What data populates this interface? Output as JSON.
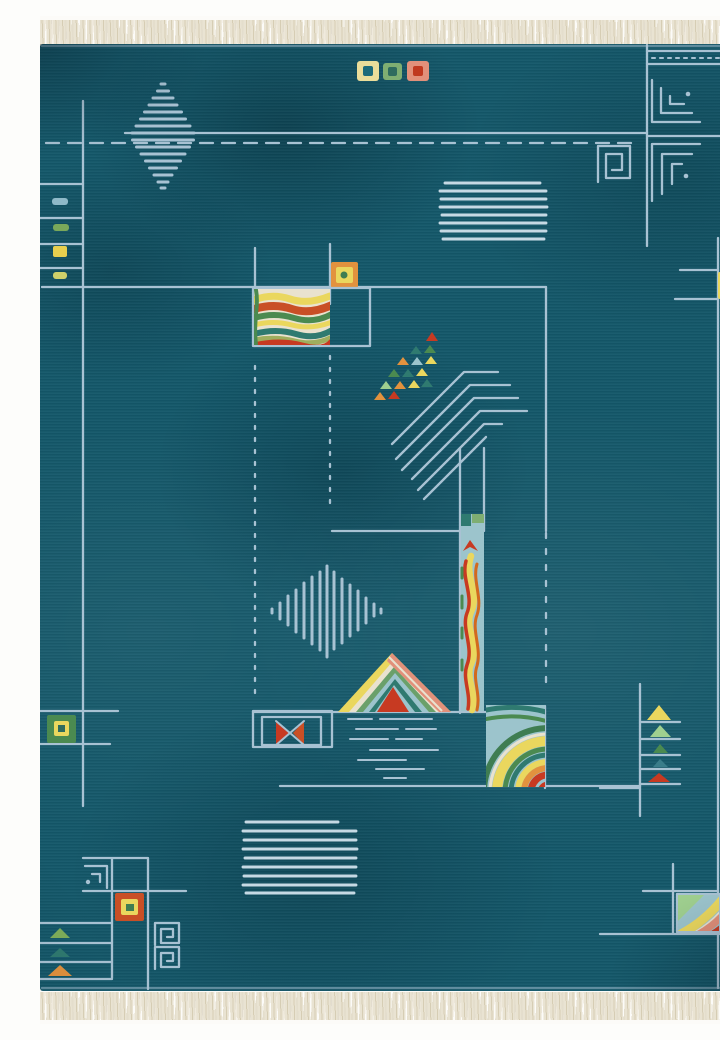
{
  "meta": {
    "description": "Photograph of a teal Art-Deco style Nepalese wool rug with ivory fringe, pale-lavender geometric line work (greek-key corner spirals, hatched diamonds, stripe blocks, dotted grid lines) and multicolor motifs: wavy rainbow panel, confetti triangle tree, serpentine totem column, striped pyramid over water lines, triangle ladder and framed accent squares.",
    "object_type": "area rug photo",
    "text_visible": "none"
  },
  "palette": {
    "base": "#14586a",
    "base-dark": "#0d4856",
    "base-light": "#1d6b7a",
    "line": "#a8c2d3",
    "line-bright": "#c6d9e4",
    "fringe": "#e9e3d2",
    "fringe-shadow": "#d6cdb4",
    "cream": "#e9e2cf",
    "yellow": "#ead75e",
    "pale-yellow": "#eadd9a",
    "orange": "#e2923e",
    "orange-red": "#c94f26",
    "red": "#c73a22",
    "green": "#4b8a50",
    "green-light": "#9fcf8f",
    "yellow-green": "#9fae5e",
    "teal-green": "#2f7a70",
    "light-blue": "#9cc4cc",
    "salmon": "#e2907a",
    "dark-teal": "#1d5a5e"
  },
  "motifs": [
    "fringe-top",
    "fringe-bottom",
    "left-border-rungs",
    "hatched-diamond-top",
    "dashed-border-line",
    "accent-squares-top",
    "greek-key-corner-top-right",
    "stripe-block-upper",
    "right-border-line",
    "pinwheel-square-right-edge",
    "center-frame-lines",
    "orange-accent-square",
    "rainbow-wave-panel",
    "confetti-triangle-tree",
    "serpentine-totem-column",
    "wave-blob",
    "striped-pyramid",
    "water-lines",
    "bowtie-box",
    "hatched-diamond-center",
    "stripe-block-lower",
    "corner-group-bottom-left",
    "triangle-ladder",
    "corner-group-bottom-right"
  ]
}
